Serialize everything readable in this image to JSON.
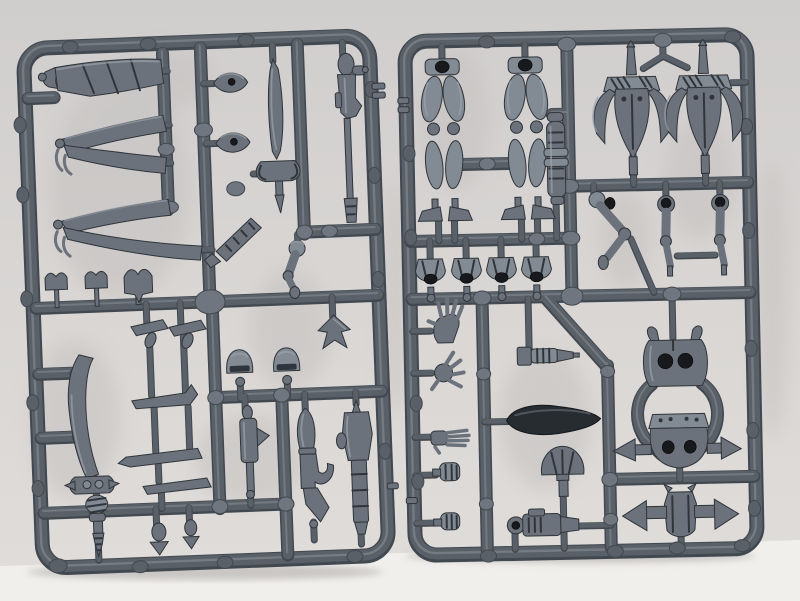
{
  "scene": {
    "caption": "Photograph of two dark blue-grey plastic injection-moulded model kit sprues standing side by side on a white surface, filled with unassembled miniature parts: banners, curved swords, rifles, pistols, legs, winged torsos, arms, hands and armour pieces.",
    "sprues": [
      {
        "label": "Left sprue frame with banners, blades and ranged weapons",
        "parts": [
          "rolled banner",
          "folded pennant banner upper",
          "folded pennant banner lower",
          "small standard top 1",
          "small standard top 2",
          "small standard top 3",
          "leaf-shaped shield boss 1",
          "leaf-shaped shield boss 2",
          "bladed spear",
          "serrated chain-blade",
          "shoulder and arm piece",
          "long splinter rifle",
          "crested helmet 1",
          "crested helmet 2",
          "dart-shaped fin",
          "trinket cluster upper",
          "trinket cluster lower",
          "compact blaster",
          "splinter pistol",
          "blast pistol",
          "great curved klaive sword",
          "hanging totem 1",
          "hanging totem 2"
        ]
      },
      {
        "label": "Right sprue frame with legs, torsos, arms, hands and armour",
        "parts": [
          "pair of legs left",
          "pair of legs right",
          "ribbed barrel cylinder",
          "winged torso front left",
          "winged torso front right",
          "bent arm",
          "straight arm left",
          "straight arm right",
          "waist piece 1",
          "waist piece 2",
          "waist piece 3",
          "waist piece 4",
          "open hand",
          "splayed hand",
          "flat hand",
          "clenched fist",
          "gripping fist",
          "ribbed drill weapon",
          "glossy blade scabbard",
          "fan-shaped trophy",
          "round-muzzle pistol",
          "torso back plate",
          "armoured belly with side blades",
          "winged waist piece"
        ]
      }
    ]
  },
  "colors": {
    "bg_wall_top": "#d0cecd",
    "bg_wall_mid": "#d9d6d4",
    "bg_wall_low": "#e0ddda",
    "bg_surface": "#f1efec",
    "bg_blotch": "#c4c1c0",
    "shadow_contact": "#a7a4a2",
    "plastic_base": "#596067",
    "plastic_dark_edge": "#42484f",
    "plastic_highlight": "#9ba2aa",
    "pad_light": "#6f767f",
    "plastic_part": "#6b727b",
    "plastic_part_light": "#828a93",
    "plastic_deep": "#30353b",
    "plastic_deep_glossy": "#272c31",
    "socket_dark": "#17191d"
  }
}
